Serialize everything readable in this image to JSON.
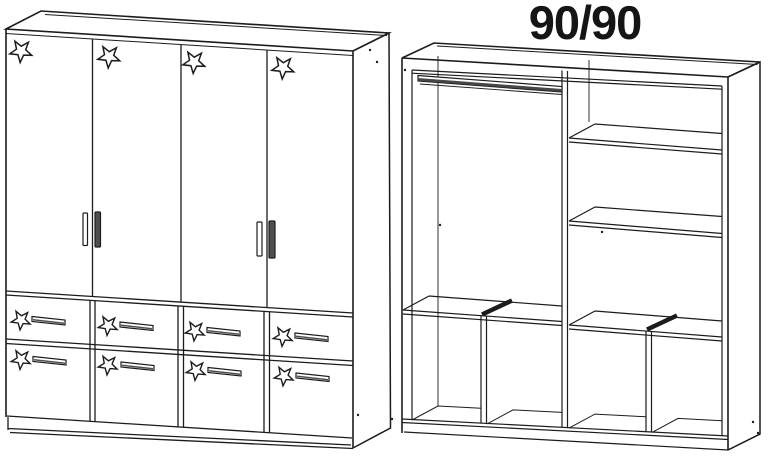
{
  "annotation": {
    "dimension_label": "90/90"
  },
  "colors": {
    "background": "#ffffff",
    "line": "#1c1c1c",
    "handle_dark": "#4f4f4f",
    "rail_dark": "#474747",
    "star_fill": "#ffffff"
  },
  "left_wardrobe": {
    "door_count": 4,
    "drawer_count": 8,
    "star_decal_count": 12,
    "door_stars": [
      {
        "cx": 21,
        "cy": 51,
        "r": 11.5
      },
      {
        "cx": 109,
        "cy": 56.5,
        "r": 11.5
      },
      {
        "cx": 194,
        "cy": 62,
        "r": 11.5
      },
      {
        "cx": 283,
        "cy": 67.5,
        "r": 11.5
      }
    ],
    "drawer_stars": [
      {
        "cx": 21,
        "cy": 320,
        "r": 10
      },
      {
        "cx": 108,
        "cy": 325.5,
        "r": 10
      },
      {
        "cx": 195,
        "cy": 331,
        "r": 10
      },
      {
        "cx": 283,
        "cy": 336.5,
        "r": 10
      },
      {
        "cx": 21,
        "cy": 359.5,
        "r": 10
      },
      {
        "cx": 108,
        "cy": 365,
        "r": 10
      },
      {
        "cx": 196,
        "cy": 370.5,
        "r": 10
      },
      {
        "cx": 284,
        "cy": 376,
        "r": 10
      }
    ],
    "drawer_handles": [
      {
        "x": 32,
        "y": 316.5
      },
      {
        "x": 120,
        "y": 322
      },
      {
        "x": 207,
        "y": 327.5
      },
      {
        "x": 295,
        "y": 333
      },
      {
        "x": 33,
        "y": 356.5
      },
      {
        "x": 121,
        "y": 362
      },
      {
        "x": 208,
        "y": 367.5
      },
      {
        "x": 296,
        "y": 373
      }
    ],
    "door_handles": [
      {
        "x": 83,
        "y": 213,
        "w": 4.5,
        "h": 32.5,
        "style": "outline"
      },
      {
        "x": 95,
        "y": 212,
        "w": 5.5,
        "h": 35,
        "style": "filled"
      },
      {
        "x": 257,
        "y": 222,
        "w": 5,
        "h": 34,
        "style": "outline"
      },
      {
        "x": 269,
        "y": 221,
        "w": 6,
        "h": 37,
        "style": "filled"
      }
    ]
  },
  "right_wardrobe": {
    "has_hanging_rail": true,
    "side_shelf_count": 2,
    "middle_shelf": true,
    "cubby_count": 4,
    "pin_dots": [
      [
        370,
        50
      ],
      [
        377,
        62
      ],
      [
        358,
        415
      ],
      [
        392,
        419
      ],
      [
        405,
        70
      ],
      [
        440,
        225
      ],
      [
        602,
        232
      ],
      [
        753,
        422
      ],
      [
        758,
        433
      ]
    ]
  }
}
